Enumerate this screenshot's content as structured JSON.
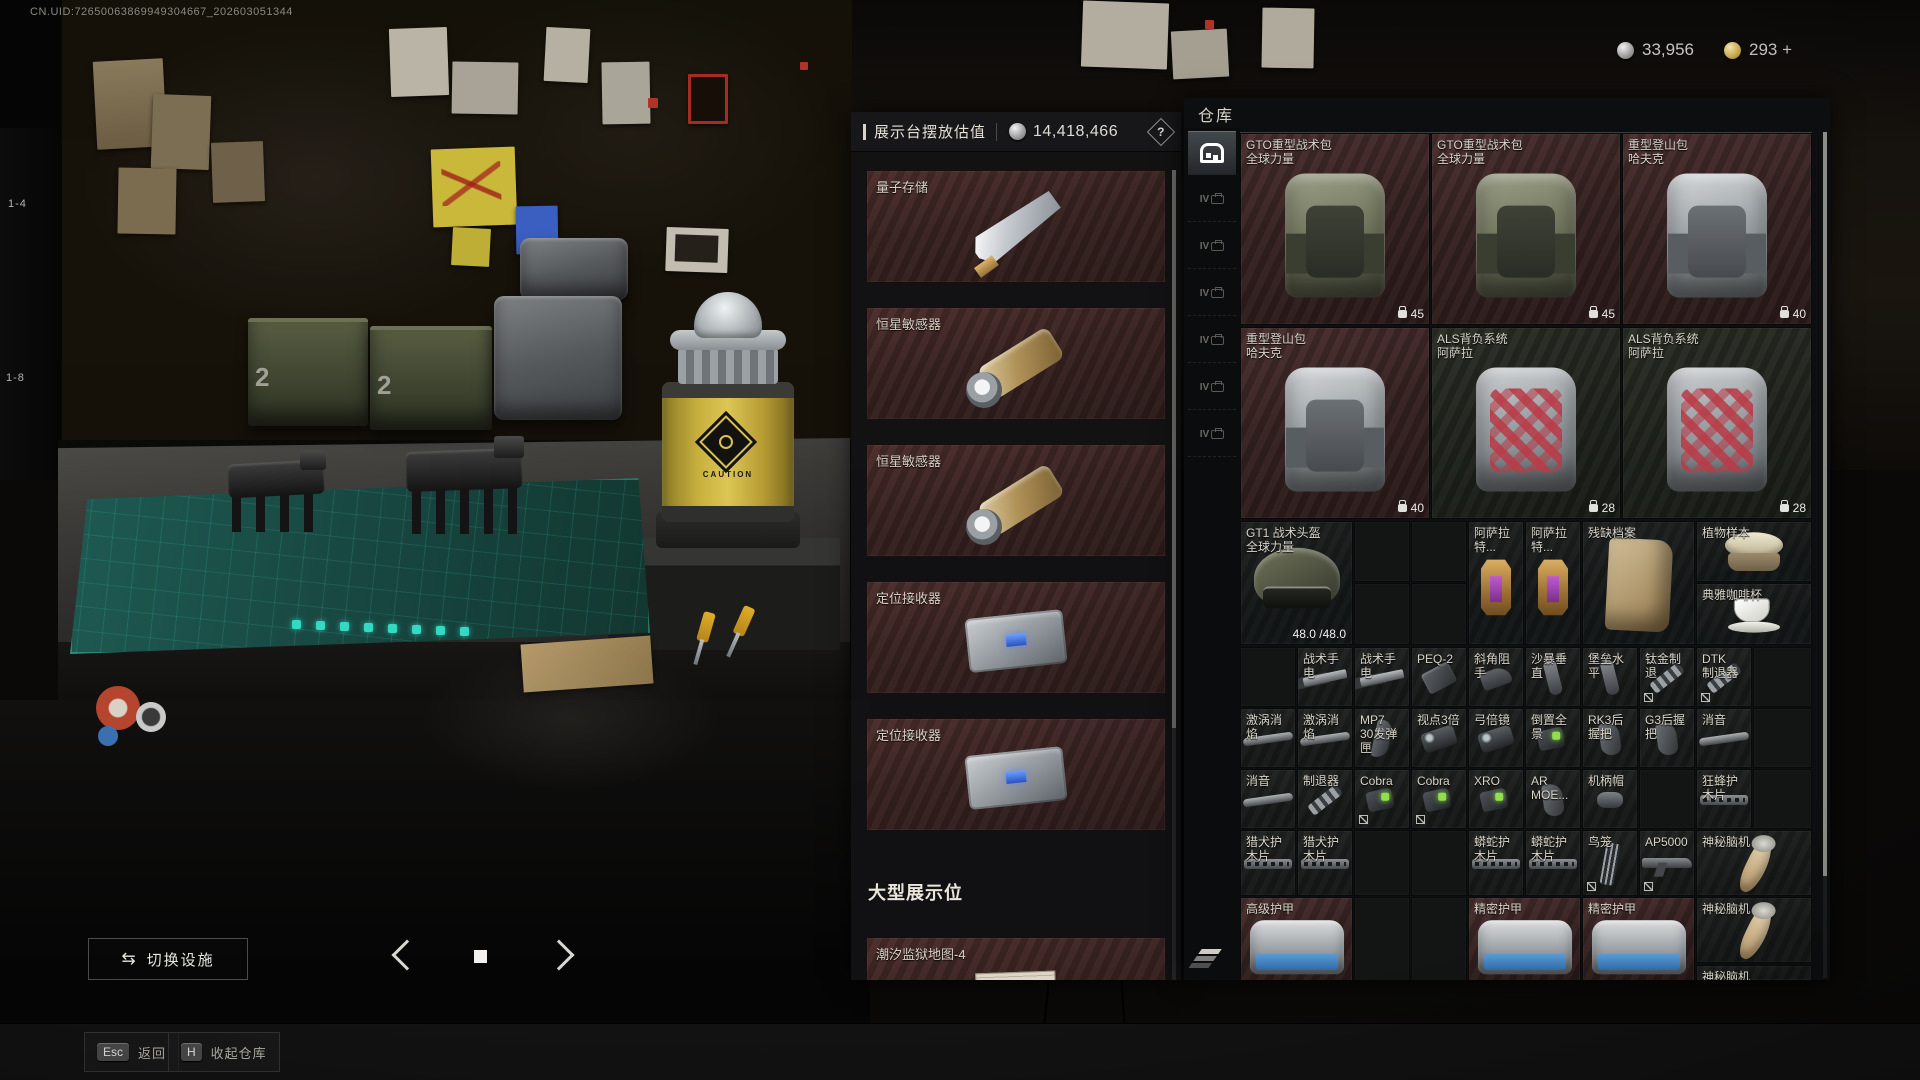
{
  "hud": {
    "uid": "CN.UID:72650063869949304667_202603051344",
    "currencies": [
      {
        "name": "silver-coin",
        "value": "33,956"
      },
      {
        "name": "gold-coin",
        "value": "293 +"
      }
    ]
  },
  "scene": {
    "shelf_labels": [
      "1-4",
      "1-8"
    ],
    "crate_numbers": [
      "2",
      "2"
    ],
    "canister_label": "CAUTION"
  },
  "display_panel": {
    "title": "展示台摆放估值",
    "value": "14,418,466",
    "help": "?",
    "slots": [
      {
        "label": "量子存储",
        "art": "quantum"
      },
      {
        "label": "恒星敏感器",
        "art": "sensor"
      },
      {
        "label": "恒星敏感器",
        "art": "sensor"
      },
      {
        "label": "定位接收器",
        "art": "receiver"
      },
      {
        "label": "定位接收器",
        "art": "receiver"
      }
    ],
    "large_section_title": "大型展示位",
    "large_slots": [
      {
        "label": "潮汐监狱地图-4",
        "art": "mapdoc"
      }
    ]
  },
  "warehouse": {
    "title": "仓库",
    "tabs": [
      {
        "name": "stash",
        "label": "",
        "selected": true
      },
      {
        "name": "case-tier",
        "label": "IV",
        "selected": false
      },
      {
        "name": "case-tier",
        "label": "IV",
        "selected": false
      },
      {
        "name": "case-tier",
        "label": "IV",
        "selected": false
      },
      {
        "name": "case-tier",
        "label": "IV",
        "selected": false
      },
      {
        "name": "case-tier",
        "label": "IV",
        "selected": false
      },
      {
        "name": "case-tier",
        "label": "IV",
        "selected": false
      }
    ],
    "items": [
      {
        "label": "GTO重型战术包",
        "sub": "全球力量",
        "x": 0,
        "y": 0,
        "w": 190,
        "h": 192,
        "bg": "maroon",
        "art": "pack-olive",
        "count": "45"
      },
      {
        "label": "GTO重型战术包",
        "sub": "全球力量",
        "x": 191,
        "y": 0,
        "w": 190,
        "h": 192,
        "bg": "maroon",
        "art": "pack-olive",
        "count": "45"
      },
      {
        "label": "重型登山包",
        "sub": "哈夫克",
        "x": 382,
        "y": 0,
        "w": 190,
        "h": 192,
        "bg": "maroon",
        "art": "pack-grey",
        "count": "40"
      },
      {
        "label": "重型登山包",
        "sub": "哈夫克",
        "x": 0,
        "y": 194,
        "w": 190,
        "h": 192,
        "bg": "maroon",
        "art": "pack-grey",
        "count": "40"
      },
      {
        "label": "ALS背负系统",
        "sub": "阿萨拉",
        "x": 191,
        "y": 194,
        "w": 190,
        "h": 192,
        "bg": "green",
        "art": "pack-red",
        "count": "28"
      },
      {
        "label": "ALS背负系统",
        "sub": "阿萨拉",
        "x": 382,
        "y": 194,
        "w": 190,
        "h": 192,
        "bg": "green",
        "art": "pack-red",
        "count": "28"
      },
      {
        "label": "GT1 战术头盔",
        "sub": "全球力量",
        "x": 0,
        "y": 388,
        "w": 113,
        "h": 124,
        "bg": "dark",
        "art": "helmet",
        "dur": "48.0 /48.0"
      },
      {
        "x": 114,
        "y": 388,
        "w": 56,
        "h": 61,
        "bg": "empty"
      },
      {
        "x": 171,
        "y": 388,
        "w": 56,
        "h": 61,
        "bg": "empty"
      },
      {
        "x": 114,
        "y": 450,
        "w": 56,
        "h": 62,
        "bg": "empty"
      },
      {
        "x": 171,
        "y": 450,
        "w": 56,
        "h": 62,
        "bg": "empty"
      },
      {
        "label": "阿萨拉特...",
        "x": 228,
        "y": 388,
        "w": 56,
        "h": 124,
        "bg": "dark",
        "art": "lantern"
      },
      {
        "label": "阿萨拉特...",
        "x": 285,
        "y": 388,
        "w": 56,
        "h": 124,
        "bg": "dark",
        "art": "lantern"
      },
      {
        "label": "残缺档案",
        "x": 342,
        "y": 388,
        "w": 113,
        "h": 124,
        "bg": "dark",
        "art": "parchment"
      },
      {
        "label": "植物样本",
        "x": 456,
        "y": 388,
        "w": 116,
        "h": 61,
        "bg": "dark",
        "art": "plant"
      },
      {
        "label": "典雅咖啡杯",
        "x": 456,
        "y": 450,
        "w": 116,
        "h": 62,
        "bg": "dark",
        "art": "cup"
      },
      {
        "x": 0,
        "y": 514,
        "w": 56,
        "h": 60,
        "bg": "empty"
      },
      {
        "label": "战术手电",
        "x": 57,
        "y": 514,
        "art": "flash"
      },
      {
        "label": "战术手电",
        "x": 114,
        "y": 514,
        "art": "flash"
      },
      {
        "label": "PEQ-2",
        "x": 171,
        "y": 514,
        "art": "laser"
      },
      {
        "label": "斜角阻手",
        "x": 228,
        "y": 514,
        "art": "grip-a"
      },
      {
        "label": "沙暴垂直",
        "x": 285,
        "y": 514,
        "art": "vgrip"
      },
      {
        "label": "堡垒水平",
        "x": 342,
        "y": 514,
        "art": "vgrip"
      },
      {
        "label": "钛金制退",
        "x": 399,
        "y": 514,
        "art": "muzzle",
        "marker": true
      },
      {
        "label": "DTK",
        "sub": "制退器",
        "x": 456,
        "y": 514,
        "art": "muzzle",
        "marker": true
      },
      {
        "x": 513,
        "y": 514,
        "w": 59,
        "h": 60,
        "bg": "empty"
      },
      {
        "label": "激涡消焰",
        "x": 0,
        "y": 575,
        "art": "supp"
      },
      {
        "label": "激涡消焰",
        "x": 57,
        "y": 575,
        "art": "supp"
      },
      {
        "label": "MP7",
        "sub": "30发弹匣",
        "x": 114,
        "y": 575,
        "art": "mag"
      },
      {
        "label": "视点3倍",
        "x": 171,
        "y": 575,
        "art": "scope"
      },
      {
        "label": "弓倍镜",
        "x": 228,
        "y": 575,
        "art": "scope"
      },
      {
        "label": "倒置全景",
        "x": 285,
        "y": 575,
        "art": "sight-g"
      },
      {
        "label": "RK3后握把",
        "x": 342,
        "y": 575,
        "art": "grip-p"
      },
      {
        "label": "G3后握把",
        "x": 399,
        "y": 575,
        "art": "grip-p"
      },
      {
        "label": "消音",
        "x": 456,
        "y": 575,
        "art": "supp"
      },
      {
        "x": 513,
        "y": 575,
        "w": 59,
        "h": 60,
        "bg": "empty"
      },
      {
        "label": "消音",
        "x": 0,
        "y": 636,
        "art": "supp"
      },
      {
        "label": "制退器",
        "x": 57,
        "y": 636,
        "art": "muzzle"
      },
      {
        "label": "Cobra",
        "x": 114,
        "y": 636,
        "art": "sight-g",
        "marker": true
      },
      {
        "label": "Cobra",
        "x": 171,
        "y": 636,
        "art": "sight-g",
        "marker": true
      },
      {
        "label": "XRO",
        "x": 228,
        "y": 636,
        "art": "sight-g"
      },
      {
        "label": "AR MOE...",
        "x": 285,
        "y": 636,
        "art": "grip-p"
      },
      {
        "label": "机柄帽",
        "x": 342,
        "y": 636,
        "art": "knob"
      },
      {
        "x": 399,
        "y": 636,
        "w": 56,
        "h": 60,
        "bg": "empty"
      },
      {
        "label": "狂蜂护木片",
        "x": 456,
        "y": 636,
        "art": "hguard"
      },
      {
        "x": 513,
        "y": 636,
        "w": 59,
        "h": 60,
        "bg": "empty"
      },
      {
        "label": "猎犬护木片",
        "x": 0,
        "y": 697,
        "h": 66,
        "art": "hguard"
      },
      {
        "label": "猎犬护木片",
        "x": 57,
        "y": 697,
        "h": 66,
        "art": "hguard"
      },
      {
        "x": 114,
        "y": 697,
        "w": 56,
        "h": 66,
        "bg": "empty"
      },
      {
        "x": 171,
        "y": 697,
        "w": 56,
        "h": 66,
        "bg": "empty"
      },
      {
        "label": "蟒蛇护木片",
        "x": 228,
        "y": 697,
        "h": 66,
        "art": "hguard"
      },
      {
        "label": "蟒蛇护木片",
        "x": 285,
        "y": 697,
        "h": 66,
        "art": "hguard"
      },
      {
        "label": "鸟笼",
        "x": 342,
        "y": 697,
        "h": 66,
        "art": "cage",
        "marker": true
      },
      {
        "label": "AP5000",
        "x": 399,
        "y": 697,
        "h": 66,
        "art": "rifle",
        "marker": true
      },
      {
        "label": "神秘脑机",
        "x": 456,
        "y": 697,
        "w": 116,
        "h": 66,
        "art": "horn"
      },
      {
        "label": "高级护甲",
        "x": 0,
        "y": 764,
        "w": 113,
        "h": 90,
        "bg": "maroon",
        "art": "duffel"
      },
      {
        "x": 114,
        "y": 764,
        "w": 56,
        "h": 90,
        "bg": "empty"
      },
      {
        "x": 171,
        "y": 764,
        "w": 56,
        "h": 90,
        "bg": "empty"
      },
      {
        "label": "精密护甲",
        "x": 228,
        "y": 764,
        "w": 113,
        "h": 90,
        "bg": "maroon",
        "art": "duffel"
      },
      {
        "label": "精密护甲",
        "x": 342,
        "y": 764,
        "w": 113,
        "h": 90,
        "bg": "maroon",
        "art": "duffel"
      },
      {
        "label": "神秘脑机",
        "x": 456,
        "y": 764,
        "w": 116,
        "h": 66,
        "art": "horn"
      },
      {
        "label": "神秘脑机",
        "x": 456,
        "y": 832,
        "w": 116,
        "h": 16,
        "cut": true
      }
    ]
  },
  "footer": {
    "switch_icon": "⇆",
    "switch_label": "切换设施",
    "keys": [
      {
        "key": "Esc",
        "label": "返回"
      },
      {
        "key": "H",
        "label": "收起仓库"
      }
    ]
  }
}
